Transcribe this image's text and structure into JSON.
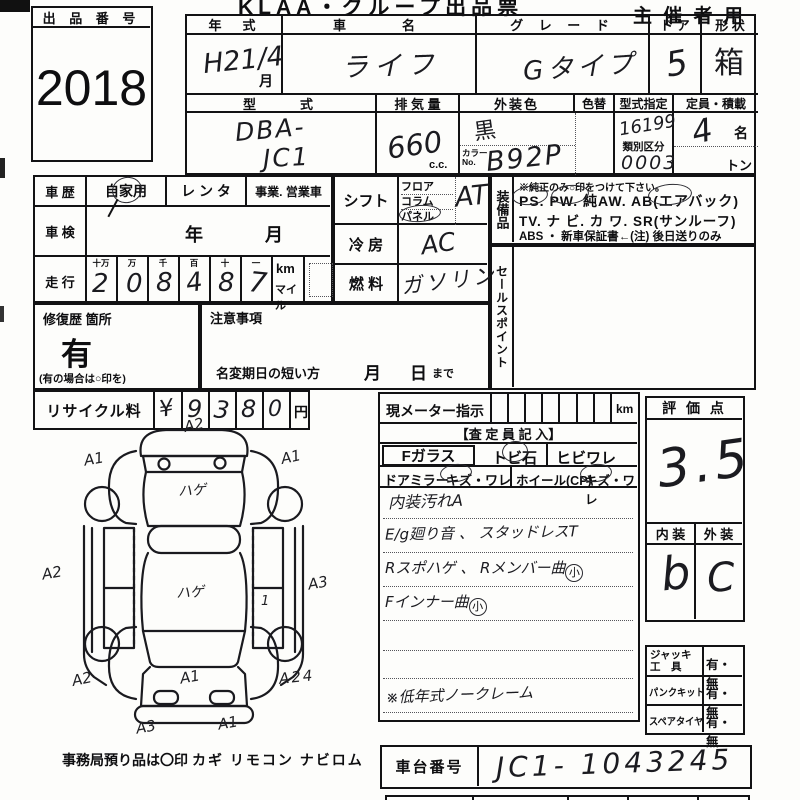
{
  "sheet": {
    "title": "KLAA・グループ出品票",
    "organizer": "主 催 者 用"
  },
  "auction": {
    "label": "出 品 番 号",
    "number": "2018"
  },
  "v": {
    "year_label": "年　式",
    "year": "H21/4",
    "year_unit": "月",
    "name_label": "車　　名",
    "name": "ライフ",
    "grade_label": "グ レ ー ド",
    "grade": "Gタイプ",
    "door_label": "ド ア",
    "door": "5",
    "shape_label": "形 状",
    "shape": "箱",
    "model_label": "型　　式",
    "model1": "DBA-",
    "model2": "JC1",
    "disp_label": "排 気 量",
    "disp": "660",
    "disp_unit": "c.c.",
    "color_label": "外装色",
    "color": "黒",
    "colorchg_label": "色替",
    "colorno_label": "カラー",
    "colorno_label2": "No.",
    "colorno": "B92P",
    "kata_label": "型式指定",
    "kata": "16199",
    "ruibetsu_label": "類別区分",
    "ruibetsu": "0003",
    "teiin_label": "定員・積載",
    "teiin": "4",
    "teiin_unit": "名",
    "ton": "トン"
  },
  "hist": {
    "label": "車 歴",
    "opt1": "自家用",
    "opt2": "レ ン タ",
    "opt3": "事業. 営業車"
  },
  "shaken": {
    "label": "車 検",
    "year": "年",
    "month": "月"
  },
  "run": {
    "label": "走 行",
    "h": [
      "十万",
      "万",
      "千",
      "百",
      "十",
      "一"
    ],
    "d": [
      "2",
      "0",
      "8",
      "4",
      "8",
      "7"
    ],
    "km": "km",
    "mile": "マイル"
  },
  "shift": {
    "label": "シフト",
    "o1": "フロア",
    "o2": "コラム",
    "o3": "パネル",
    "val": "AT"
  },
  "ac": {
    "label": "冷 房",
    "val": "AC"
  },
  "fuel": {
    "label": "燃 料",
    "val": "ガソリン"
  },
  "equip": {
    "label": "装備品",
    "note": "※純正のみ○印をつけて下さい。",
    "l1": "PS.  PW.  純AW.  AB(エアバック)",
    "l2": "TV. ナ ビ. カ ワ. SR(サンルーフ)",
    "l3": "ABS ・ 新車保証書←(注) 後日送りのみ"
  },
  "sales": {
    "label": "セールスポイント"
  },
  "repair": {
    "label": "修復歴 箇所",
    "val": "有",
    "note": "(有の場合は○印を)"
  },
  "caution": {
    "label": "注意事項",
    "l1": "名変期日の短い方",
    "m": "月",
    "d": "日",
    "made": "まで"
  },
  "recycle": {
    "label": "リサイクル料",
    "d": [
      "¥",
      "9",
      "3",
      "8",
      "0"
    ],
    "unit": "円"
  },
  "meter": {
    "label": "現メーター指示",
    "km": "km",
    "assessor": "【査 定 員 記 入】",
    "glass": "Fガラス",
    "tobi": "トビ石",
    "hibi": "ヒビワレ",
    "mirror": "ドアミラー",
    "kizu": "キズ・ワレ",
    "wheel": "ホイール(CP)",
    "kizu2": "キズ・ワレ",
    "n1": "内装汚れA",
    "n2": "E/g廻り音 、 スタッドレスT",
    "n3": "Rスポハゲ 、 Rメンバー曲",
    "n4": "Fインナー曲",
    "small": "小",
    "n5": "※低年式ノークレーム"
  },
  "score": {
    "label": "評 価 点",
    "val": "3.5",
    "int_label": "内 装",
    "ext_label": "外 装",
    "int": "b",
    "ext": "C"
  },
  "acc": {
    "r1a": "ジャッキ",
    "r1b": "工　具",
    "r1v": "有・無",
    "r2a": "パンクキット",
    "r2v": "有・無",
    "r3a": "スペアタイヤ",
    "r3v": "有・無"
  },
  "chassis": {
    "label": "車台番号",
    "val": "JC1- 1043245"
  },
  "marks": [
    "A2",
    "A1",
    "A1",
    "ハゲ",
    "A2",
    "ハゲ",
    "A3",
    "1",
    "A2",
    "A1",
    "A24",
    "A3",
    "A1"
  ],
  "footer": {
    "a": "事務局預り品は〇印",
    "b": "カギ  リモコン  ナビロム"
  }
}
